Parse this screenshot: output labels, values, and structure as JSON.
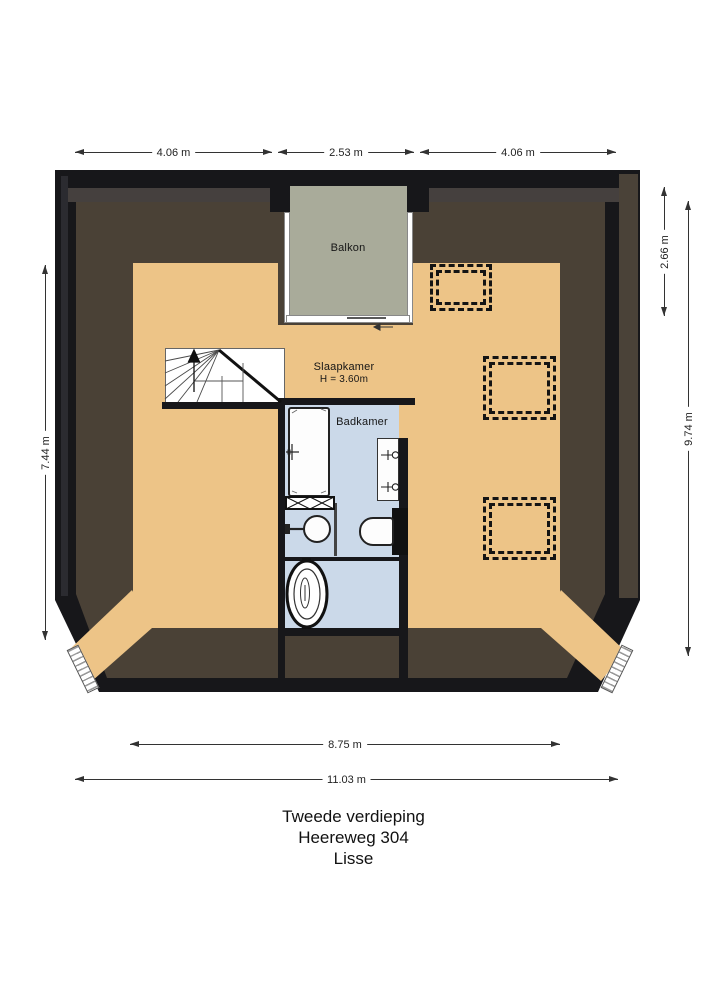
{
  "title": {
    "line1": "Tweede verdieping",
    "line2": "Heereweg 304",
    "line3": "Lisse"
  },
  "rooms": {
    "balcony": {
      "label": "Balkon"
    },
    "bedroom": {
      "label": "Slaapkamer",
      "height_note": "H = 3.60m"
    },
    "bathroom": {
      "label": "Badkamer"
    }
  },
  "dimensions": {
    "top_left": "4.06 m",
    "top_middle": "2.53 m",
    "top_right": "4.06 m",
    "left_height": "7.44 m",
    "right_balcony_depth": "2.66 m",
    "right_total_height": "9.74 m",
    "bottom_inner_width": "8.75 m",
    "bottom_total_width": "11.03 m"
  },
  "colors": {
    "wall": "#17171a",
    "roof": "#4a4136",
    "floor": "#edc487",
    "balcony": "#a9ab9a",
    "bath": "#cbd9e9",
    "lining": "#45403e",
    "band": "#4a4238"
  },
  "fixtures": [
    "staircase",
    "bathtub",
    "towel-radiator",
    "shower",
    "glass-partition",
    "toilet",
    "freestanding-toilet",
    "double-sink-vanity",
    "roof-window-1",
    "roof-window-2",
    "roof-window-3",
    "corner-window-left",
    "corner-window-right",
    "balcony-sliding-door"
  ]
}
